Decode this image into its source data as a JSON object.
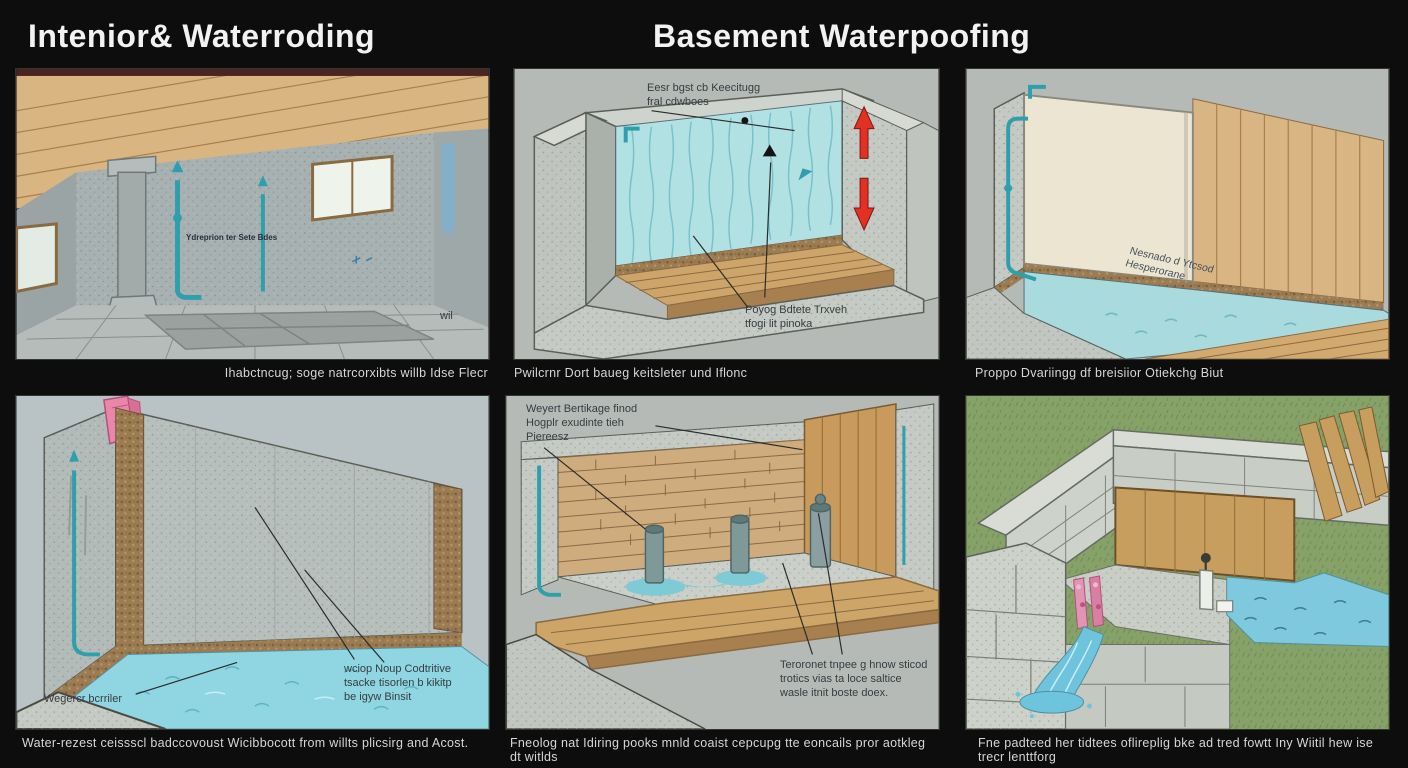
{
  "titles": {
    "left": "Intenior& Waterroding",
    "right": "Basement Waterpoofing"
  },
  "panels": [
    {
      "name": "interior-basement-room",
      "caption": "Ihabctncug; soge natrcorxibts willb Idse Flecr",
      "labels": {
        "pipe": "Ydreprion ter Sete Bdes",
        "wall": "wil"
      }
    },
    {
      "name": "cutaway-wall-water",
      "caption": "Pwilcrnr Dort baueg keitsleter und Iflonc",
      "labels": {
        "top": "Eesr bgst cb Keecitugg\nfral cdwboes",
        "mid": "Poyog Bdtete Trxveh\ntfogi lit pinoka"
      }
    },
    {
      "name": "corner-interior-panels",
      "caption": "Proppo Dvariingg df breisiior Otiekchg Biut",
      "labels": {
        "floor": "Nesnado d Ytcsod\nHesperorane"
      }
    },
    {
      "name": "flooded-room-barrier",
      "caption": "Water-rezest ceissscl badccovoust Wicibbocott from willts plicsirg and Acost.",
      "labels": {
        "barrier": "Wegercr bcrriler",
        "note": "wciop Noup Codtritive\ntsacke tisorlen b kikitp\nbe igyw Binsit"
      }
    },
    {
      "name": "sump-pump-cutaway",
      "caption": "Fneolog nat Idiring pooks mnld coaist cepcupg tte eoncails pror aotkleg dt witlds",
      "labels": {
        "top": "Weyert Bertikage finod\nHogplr exudinte tieh\nPiereesz",
        "bottom": "Teroronet tnpee g hnow sticod\ntrotics vias ta loce saltice\nwasle itnit boste doex."
      }
    },
    {
      "name": "exterior-drainage",
      "caption": "Fne padteed her tidtees oflireplig bke ad tred fowtt Iny Wiitil hew ise trecr lenttforg"
    }
  ],
  "colors": {
    "background": "#0d0d0d",
    "panel_bg": "#b5bab6",
    "wood": "#d9b583",
    "water": "#8fd6e2",
    "pipe_teal": "#2f9fae",
    "arrow_red": "#e23025",
    "gravel": "#9c7c53",
    "grass": "#87a269",
    "caption_text": "#d6d6d6",
    "label_text": "#363d41"
  }
}
